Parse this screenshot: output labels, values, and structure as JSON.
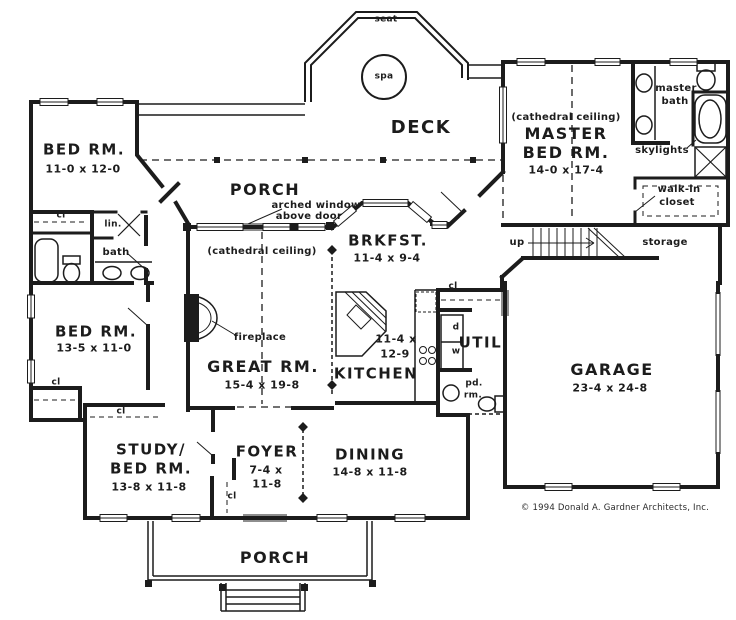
{
  "copyright": "© 1994 Donald A. Gardner Architects, Inc.",
  "outdoor": {
    "deck_label": "DECK",
    "seat_label": "seat",
    "spa_label": "spa",
    "front_porch_label": "PORCH",
    "rear_porch_label": "PORCH",
    "arched_window_line1": "arched window",
    "arched_window_line2": "above door"
  },
  "rooms": {
    "bedroom_upper": {
      "name": "BED RM.",
      "dims": "11-0 x 12-0"
    },
    "bedroom_lower": {
      "name": "BED RM.",
      "dims": "13-5 x 11-0"
    },
    "study_bedroom": {
      "name_line1": "STUDY/",
      "name_line2": "BED RM.",
      "dims": "13-8 x 11-8"
    },
    "great_room": {
      "ceiling_note": "(cathedral ceiling)",
      "name": "GREAT RM.",
      "dims": "15-4 x 19-8"
    },
    "master_bedroom": {
      "ceiling_note": "(cathedral ceiling)",
      "name_line1": "MASTER",
      "name_line2": "BED RM.",
      "dims": "14-0 x 17-4"
    },
    "breakfast": {
      "name": "BRKFST.",
      "dims": "11-4 x 9-4"
    },
    "kitchen": {
      "name": "KITCHEN",
      "dims_line1": "11-4 x",
      "dims_line2": "12-9"
    },
    "dining": {
      "name": "DINING",
      "dims": "14-8 x 11-8"
    },
    "foyer": {
      "name": "FOYER",
      "dims_line1": "7-4 x",
      "dims_line2": "11-8"
    },
    "garage": {
      "name": "GARAGE",
      "dims": "23-4 x 24-8"
    },
    "utility": {
      "name": "UTIL."
    },
    "powder_room": {
      "name_line1": "pd.",
      "name_line2": "rm."
    },
    "master_bath": {
      "name_line1": "master",
      "name_line2": "bath"
    },
    "walk_in_closet": {
      "name_line1": "walk-in",
      "name_line2": "closet"
    },
    "bath": {
      "name": "bath"
    },
    "linen": {
      "name": "lin."
    },
    "storage": {
      "name": "storage"
    }
  },
  "annotations": {
    "closet_abbrev": "cl",
    "up": "up",
    "dryer": "d",
    "washer": "w",
    "fireplace": "fireplace",
    "skylights": "skylights"
  },
  "colors": {
    "ink": "#1c1c1c",
    "paper": "#ffffff"
  }
}
